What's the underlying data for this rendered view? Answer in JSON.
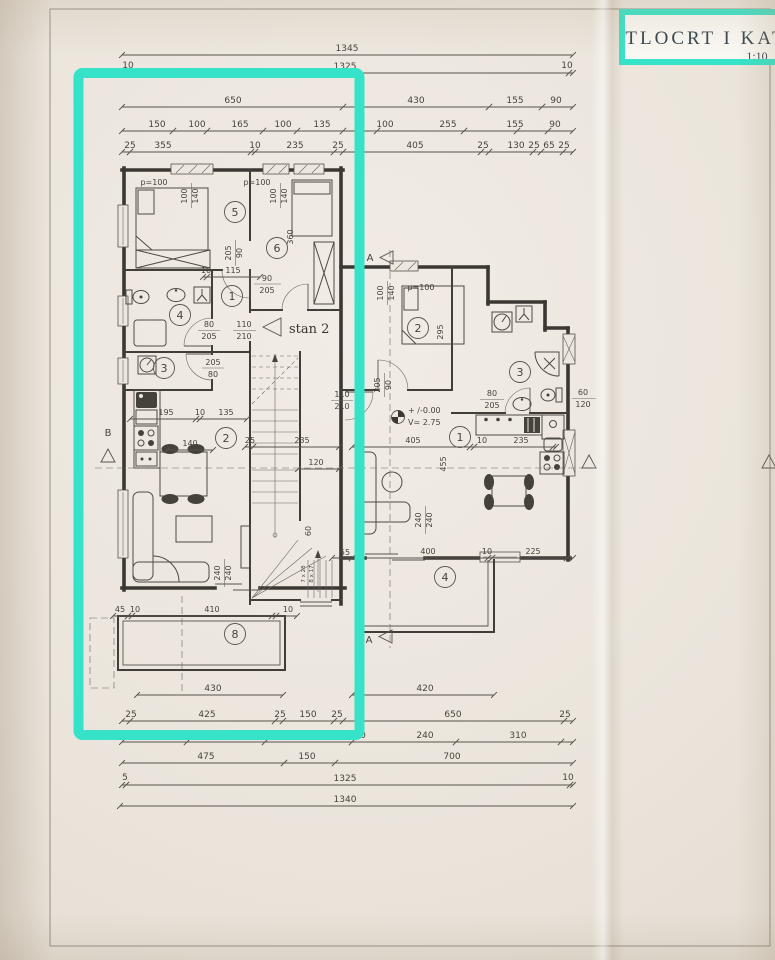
{
  "title_block": {
    "title": "TLOCRT I KAT",
    "scale": "1:10"
  },
  "section_markers": {
    "a": "A",
    "b": "B"
  },
  "plan_labels": {
    "apartment": "stan 2",
    "datum": "+ /-0.00",
    "room_height": "V= 2.75",
    "stair_note_a": "7 x 28",
    "stair_note_b": "8 x 17"
  },
  "room_numbers": {
    "left": [
      "5",
      "6",
      "1",
      "4",
      "3",
      "2",
      "8"
    ],
    "right": [
      "2",
      "3",
      "1",
      "4"
    ]
  },
  "dims": {
    "t1": [
      "1345"
    ],
    "t2": [
      "10",
      "1325",
      "10"
    ],
    "t3": [
      "650",
      "430",
      "155",
      "90"
    ],
    "t4": [
      "150",
      "100",
      "165",
      "100",
      "135",
      "100",
      "255",
      "155",
      "90"
    ],
    "t5": [
      "25",
      "355",
      "10",
      "235",
      "25",
      "405",
      "25",
      "130",
      "25",
      "65",
      "25"
    ],
    "b1": [
      "430",
      "420"
    ],
    "b2": [
      "25",
      "425",
      "25",
      "150",
      "25",
      "650",
      "25"
    ],
    "b3": [
      "0",
      "240",
      "310"
    ],
    "b4": [
      "475",
      "150",
      "700"
    ],
    "b5": [
      "5",
      "1325",
      "10"
    ],
    "b6": [
      "1340"
    ],
    "terr": [
      "45",
      "10",
      "410",
      "10"
    ],
    "kitl": [
      "195",
      "10",
      "135"
    ],
    "hall": [
      "10",
      "115",
      "90",
      "205"
    ],
    "door56": [
      "205",
      "90"
    ],
    "winl": [
      "p=100",
      "100",
      "140",
      "p=100",
      "100",
      "140",
      "360"
    ],
    "doorl": [
      "110",
      "210",
      "80",
      "205",
      "205",
      "80"
    ],
    "stair": [
      "25",
      "235",
      "120",
      "60",
      "55"
    ],
    "tbl": [
      "140"
    ],
    "sofal": [
      "240",
      "240"
    ],
    "rmr": [
      "100",
      "140",
      "p=100",
      "295"
    ],
    "doorr": [
      "205",
      "90",
      "110",
      "210",
      "80",
      "205"
    ],
    "winr": [
      "60",
      "120"
    ],
    "kitr": [
      "405",
      "10",
      "235",
      "455"
    ],
    "sofar": [
      "240",
      "240"
    ],
    "botr": [
      "400",
      "10",
      "225"
    ]
  }
}
